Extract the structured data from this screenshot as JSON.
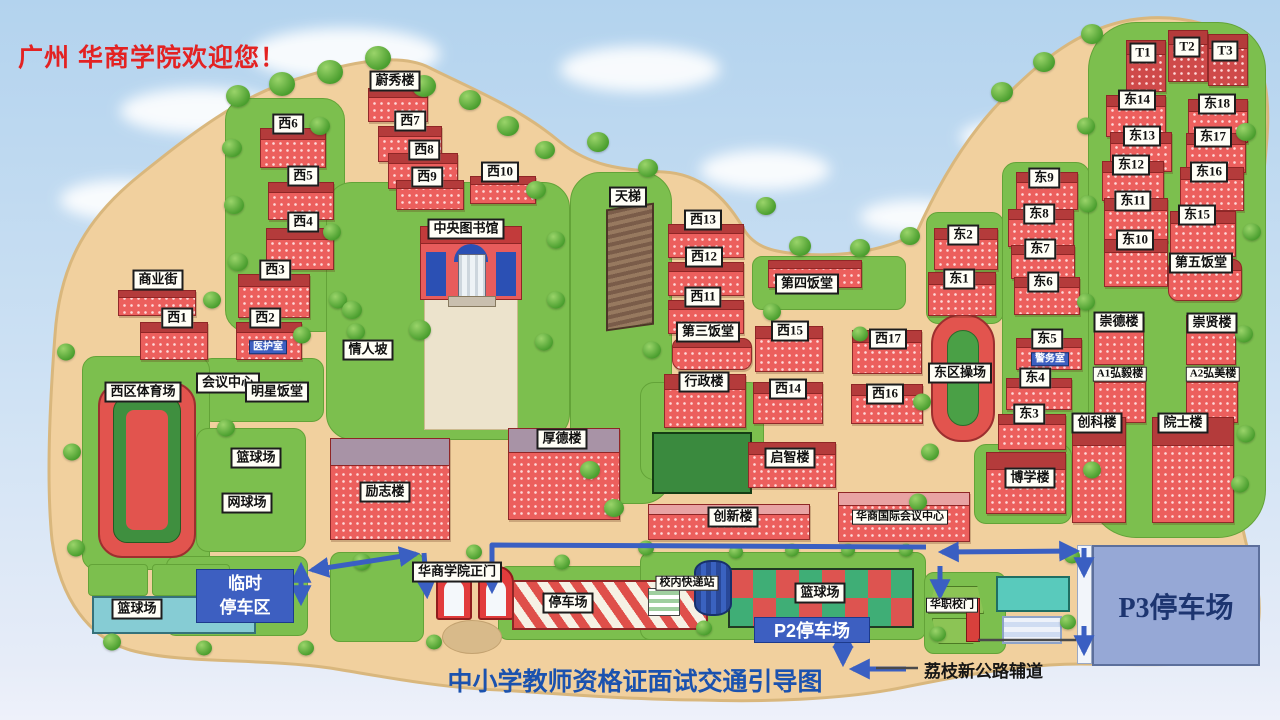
{
  "welcome_text": "广州 华商学院欢迎您！",
  "caption": "中小学教师资格证面试交通引导图",
  "signs": {
    "p3": "P3停车场",
    "p2": "P2停车场",
    "temp1": "临时",
    "temp2": "停车区",
    "road": "荔枝新公路辅道"
  },
  "colors": {
    "arrow": "#3a5fc2",
    "sand": "#f1d09e",
    "green": "#7cbf4e",
    "building": "#ec5f5d",
    "roof": "#b43b3b",
    "p3_bg": "#96a8d6",
    "p3_text": "#1d3570",
    "blue_sign": "#3d5fc1",
    "caption_text": "#1b52ae",
    "welcome_text": "#e32222"
  },
  "map": {
    "labels": [
      {
        "t": "蔚秀楼",
        "x": 395,
        "y": 81
      },
      {
        "t": "西6",
        "x": 288,
        "y": 124
      },
      {
        "t": "西7",
        "x": 410,
        "y": 121
      },
      {
        "t": "西8",
        "x": 424,
        "y": 150
      },
      {
        "t": "西9",
        "x": 427,
        "y": 177
      },
      {
        "t": "西10",
        "x": 500,
        "y": 172
      },
      {
        "t": "西5",
        "x": 303,
        "y": 176
      },
      {
        "t": "西4",
        "x": 303,
        "y": 222
      },
      {
        "t": "西3",
        "x": 275,
        "y": 270
      },
      {
        "t": "商业街",
        "x": 158,
        "y": 280
      },
      {
        "t": "西1",
        "x": 177,
        "y": 318
      },
      {
        "t": "西2",
        "x": 265,
        "y": 318
      },
      {
        "t": "医护室",
        "x": 268,
        "y": 347,
        "s": "tag"
      },
      {
        "t": "会议中心",
        "x": 228,
        "y": 383
      },
      {
        "t": "明星饭堂",
        "x": 277,
        "y": 392
      },
      {
        "t": "西区体育场",
        "x": 143,
        "y": 392
      },
      {
        "t": "中央图书馆",
        "x": 466,
        "y": 229
      },
      {
        "t": "情人坡",
        "x": 368,
        "y": 350
      },
      {
        "t": "天梯",
        "x": 628,
        "y": 197
      },
      {
        "t": "西13",
        "x": 703,
        "y": 220
      },
      {
        "t": "西12",
        "x": 704,
        "y": 257
      },
      {
        "t": "西11",
        "x": 703,
        "y": 297
      },
      {
        "t": "第三饭堂",
        "x": 708,
        "y": 332
      },
      {
        "t": "第四饭堂",
        "x": 807,
        "y": 284
      },
      {
        "t": "西15",
        "x": 790,
        "y": 331
      },
      {
        "t": "西17",
        "x": 888,
        "y": 339
      },
      {
        "t": "西14",
        "x": 788,
        "y": 389
      },
      {
        "t": "西16",
        "x": 885,
        "y": 394
      },
      {
        "t": "篮球场",
        "x": 256,
        "y": 458
      },
      {
        "t": "网球场",
        "x": 247,
        "y": 503
      },
      {
        "t": "行政楼",
        "x": 704,
        "y": 382
      },
      {
        "t": "厚德楼",
        "x": 562,
        "y": 439
      },
      {
        "t": "励志楼",
        "x": 385,
        "y": 492
      },
      {
        "t": "启智楼",
        "x": 790,
        "y": 458
      },
      {
        "t": "创新楼",
        "x": 733,
        "y": 517
      },
      {
        "t": "华商国际会议中心",
        "x": 900,
        "y": 517,
        "s": "sm"
      },
      {
        "t": "博学楼",
        "x": 1030,
        "y": 478
      },
      {
        "t": "东区操场",
        "x": 960,
        "y": 373
      },
      {
        "t": "东2",
        "x": 963,
        "y": 235
      },
      {
        "t": "东1",
        "x": 959,
        "y": 279
      },
      {
        "t": "东9",
        "x": 1044,
        "y": 178
      },
      {
        "t": "东8",
        "x": 1039,
        "y": 214
      },
      {
        "t": "东7",
        "x": 1040,
        "y": 249
      },
      {
        "t": "东6",
        "x": 1043,
        "y": 282
      },
      {
        "t": "东5",
        "x": 1047,
        "y": 339
      },
      {
        "t": "警务室",
        "x": 1050,
        "y": 359,
        "s": "tag"
      },
      {
        "t": "东4",
        "x": 1035,
        "y": 378
      },
      {
        "t": "东3",
        "x": 1029,
        "y": 414
      },
      {
        "t": "T1",
        "x": 1143,
        "y": 53
      },
      {
        "t": "T2",
        "x": 1187,
        "y": 47
      },
      {
        "t": "T3",
        "x": 1225,
        "y": 51
      },
      {
        "t": "东14",
        "x": 1137,
        "y": 100
      },
      {
        "t": "东18",
        "x": 1217,
        "y": 104
      },
      {
        "t": "东13",
        "x": 1142,
        "y": 136
      },
      {
        "t": "东17",
        "x": 1213,
        "y": 137
      },
      {
        "t": "东12",
        "x": 1131,
        "y": 165
      },
      {
        "t": "东16",
        "x": 1209,
        "y": 172
      },
      {
        "t": "东11",
        "x": 1133,
        "y": 201
      },
      {
        "t": "东15",
        "x": 1197,
        "y": 215
      },
      {
        "t": "东10",
        "x": 1135,
        "y": 240
      },
      {
        "t": "第五饭堂",
        "x": 1201,
        "y": 263
      },
      {
        "t": "崇德楼",
        "x": 1119,
        "y": 322
      },
      {
        "t": "崇贤楼",
        "x": 1212,
        "y": 323
      },
      {
        "t": "A1弘毅楼",
        "x": 1120,
        "y": 374,
        "s": "sm"
      },
      {
        "t": "A2弘美楼",
        "x": 1213,
        "y": 374,
        "s": "sm"
      },
      {
        "t": "创科楼",
        "x": 1097,
        "y": 423
      },
      {
        "t": "院士楼",
        "x": 1183,
        "y": 423
      },
      {
        "t": "篮球场",
        "x": 137,
        "y": 609
      },
      {
        "t": "华商学院正门",
        "x": 457,
        "y": 572
      },
      {
        "t": "停车场",
        "x": 568,
        "y": 603
      },
      {
        "t": "校内快递站",
        "x": 687,
        "y": 583,
        "s": "sm"
      },
      {
        "t": "篮球场",
        "x": 820,
        "y": 593
      },
      {
        "t": "华职校门",
        "x": 952,
        "y": 605,
        "s": "sm"
      }
    ],
    "buildings": [
      [
        368,
        88,
        58,
        32
      ],
      [
        378,
        126,
        62,
        34
      ],
      [
        388,
        153,
        68,
        34
      ],
      [
        396,
        180,
        66,
        28
      ],
      [
        470,
        176,
        64,
        26
      ],
      [
        260,
        128,
        64,
        38
      ],
      [
        268,
        182,
        64,
        36
      ],
      [
        266,
        228,
        66,
        40
      ],
      [
        238,
        274,
        70,
        42
      ],
      [
        118,
        290,
        76,
        24
      ],
      [
        140,
        322,
        66,
        36
      ],
      [
        236,
        322,
        64,
        36
      ],
      [
        668,
        224,
        74,
        32
      ],
      [
        668,
        262,
        74,
        32
      ],
      [
        668,
        300,
        74,
        32
      ],
      [
        672,
        338,
        78,
        30,
        "round"
      ],
      [
        768,
        260,
        92,
        26
      ],
      [
        755,
        326,
        66,
        44
      ],
      [
        852,
        330,
        68,
        42
      ],
      [
        753,
        382,
        68,
        40
      ],
      [
        851,
        384,
        70,
        38
      ],
      [
        664,
        374,
        80,
        52
      ],
      [
        508,
        428,
        110,
        90,
        "gray"
      ],
      [
        330,
        438,
        118,
        100,
        "gray"
      ],
      [
        748,
        442,
        86,
        44
      ],
      [
        648,
        504,
        160,
        34,
        "pink"
      ],
      [
        838,
        492,
        130,
        48,
        "pink"
      ],
      [
        986,
        452,
        78,
        60
      ],
      [
        934,
        228,
        62,
        40
      ],
      [
        928,
        272,
        66,
        42
      ],
      [
        1016,
        172,
        60,
        36
      ],
      [
        1008,
        209,
        64,
        36
      ],
      [
        1011,
        245,
        62,
        32
      ],
      [
        1014,
        277,
        64,
        36
      ],
      [
        1016,
        338,
        64,
        30
      ],
      [
        1006,
        378,
        64,
        30
      ],
      [
        998,
        414,
        66,
        34
      ],
      [
        1126,
        40,
        38,
        50,
        "dark"
      ],
      [
        1168,
        30,
        38,
        50,
        "dark"
      ],
      [
        1208,
        34,
        38,
        50,
        "dark"
      ],
      [
        1106,
        95,
        58,
        40
      ],
      [
        1188,
        99,
        58,
        42
      ],
      [
        1110,
        132,
        60,
        38
      ],
      [
        1186,
        133,
        58,
        38
      ],
      [
        1102,
        161,
        60,
        38
      ],
      [
        1180,
        167,
        62,
        42
      ],
      [
        1104,
        198,
        62,
        42
      ],
      [
        1170,
        211,
        64,
        44
      ],
      [
        1104,
        239,
        62,
        46
      ],
      [
        1168,
        259,
        72,
        40,
        "round"
      ],
      [
        1094,
        315,
        48,
        48
      ],
      [
        1186,
        315,
        48,
        48
      ],
      [
        1094,
        367,
        50,
        54
      ],
      [
        1186,
        367,
        50,
        54
      ],
      [
        1072,
        417,
        52,
        104
      ],
      [
        1152,
        417,
        80,
        104
      ]
    ],
    "greens": [
      [
        225,
        98,
        118,
        232,
        22
      ],
      [
        200,
        358,
        122,
        62,
        12
      ],
      [
        82,
        356,
        126,
        212,
        14
      ],
      [
        196,
        428,
        108,
        122,
        12
      ],
      [
        326,
        182,
        242,
        256,
        26
      ],
      [
        570,
        172,
        100,
        330,
        30
      ],
      [
        640,
        382,
        122,
        96,
        14
      ],
      [
        752,
        256,
        152,
        52,
        10
      ],
      [
        926,
        212,
        76,
        110,
        12
      ],
      [
        1002,
        162,
        86,
        298,
        14
      ],
      [
        1088,
        22,
        176,
        514,
        48
      ],
      [
        974,
        444,
        96,
        78,
        12
      ],
      [
        166,
        556,
        140,
        78,
        10
      ],
      [
        88,
        564,
        58,
        30,
        4
      ],
      [
        152,
        564,
        76,
        30,
        4
      ],
      [
        330,
        552,
        92,
        88,
        10
      ],
      [
        498,
        566,
        208,
        72,
        10
      ],
      [
        640,
        552,
        284,
        86,
        10
      ],
      [
        924,
        572,
        80,
        80,
        10
      ]
    ],
    "trees": [
      [
        238,
        96,
        24
      ],
      [
        282,
        84,
        26
      ],
      [
        330,
        72,
        26
      ],
      [
        378,
        58,
        26
      ],
      [
        424,
        86,
        24
      ],
      [
        470,
        100,
        22
      ],
      [
        508,
        126,
        22
      ],
      [
        545,
        150,
        20
      ],
      [
        232,
        148,
        20
      ],
      [
        234,
        205,
        20
      ],
      [
        238,
        262,
        20
      ],
      [
        320,
        126,
        20
      ],
      [
        332,
        232,
        18
      ],
      [
        338,
        300,
        18
      ],
      [
        302,
        335,
        18
      ],
      [
        356,
        332,
        18
      ],
      [
        212,
        300,
        18
      ],
      [
        226,
        428,
        18
      ],
      [
        300,
        388,
        16
      ],
      [
        420,
        330,
        22
      ],
      [
        352,
        310,
        20
      ],
      [
        536,
        190,
        20
      ],
      [
        556,
        240,
        18
      ],
      [
        556,
        300,
        18
      ],
      [
        544,
        342,
        18
      ],
      [
        598,
        142,
        22
      ],
      [
        648,
        168,
        20
      ],
      [
        590,
        470,
        20
      ],
      [
        614,
        508,
        20
      ],
      [
        652,
        350,
        18
      ],
      [
        766,
        206,
        20
      ],
      [
        800,
        246,
        22
      ],
      [
        860,
        248,
        20
      ],
      [
        910,
        236,
        20
      ],
      [
        772,
        312,
        18
      ],
      [
        860,
        334,
        16
      ],
      [
        922,
        402,
        18
      ],
      [
        930,
        452,
        18
      ],
      [
        918,
        502,
        18
      ],
      [
        1002,
        92,
        22
      ],
      [
        1044,
        62,
        22
      ],
      [
        1092,
        34,
        22
      ],
      [
        1086,
        126,
        18
      ],
      [
        1088,
        204,
        18
      ],
      [
        1086,
        302,
        18
      ],
      [
        1092,
        470,
        18
      ],
      [
        1246,
        132,
        20
      ],
      [
        1252,
        232,
        18
      ],
      [
        1244,
        334,
        18
      ],
      [
        1246,
        434,
        18
      ],
      [
        1240,
        484,
        18
      ],
      [
        66,
        352,
        18
      ],
      [
        72,
        452,
        18
      ],
      [
        76,
        548,
        18
      ],
      [
        112,
        642,
        18
      ],
      [
        204,
        648,
        16
      ],
      [
        306,
        648,
        16
      ],
      [
        362,
        562,
        18
      ],
      [
        434,
        642,
        16
      ],
      [
        474,
        552,
        16
      ],
      [
        562,
        562,
        16
      ],
      [
        646,
        548,
        16
      ],
      [
        704,
        628,
        16
      ],
      [
        736,
        552,
        14
      ],
      [
        792,
        550,
        14
      ],
      [
        848,
        550,
        14
      ],
      [
        906,
        550,
        14
      ],
      [
        938,
        634,
        16
      ],
      [
        1072,
        556,
        16
      ],
      [
        1068,
        622,
        16
      ]
    ],
    "arrows": [
      {
        "d": "M1076 551 L942 552",
        "both": true
      },
      {
        "d": "M926 547 L492 545 L492 590"
      },
      {
        "d": "M424 553 L427 595"
      },
      {
        "d": "M312 570 L416 554",
        "both": true
      },
      {
        "d": "M301 566 L301 602",
        "both": true
      },
      {
        "d": "M843 631 L843 663",
        "both": true
      },
      {
        "d": "M906 669 L853 669"
      },
      {
        "d": "M1084 548 L1084 574"
      },
      {
        "d": "M1084 626 L1084 652"
      },
      {
        "d": "M940 566 L940 596"
      }
    ],
    "road_lines": [
      "M978 640 L1076 640",
      "M876 668 L918 668"
    ],
    "clouds": [
      [
        250,
        28,
        190,
        52
      ],
      [
        120,
        88,
        160,
        46
      ],
      [
        560,
        46,
        160,
        46
      ],
      [
        700,
        150,
        130,
        40
      ],
      [
        860,
        200,
        110,
        34
      ],
      [
        60,
        180,
        120,
        40
      ],
      [
        960,
        120,
        100,
        34
      ]
    ]
  }
}
